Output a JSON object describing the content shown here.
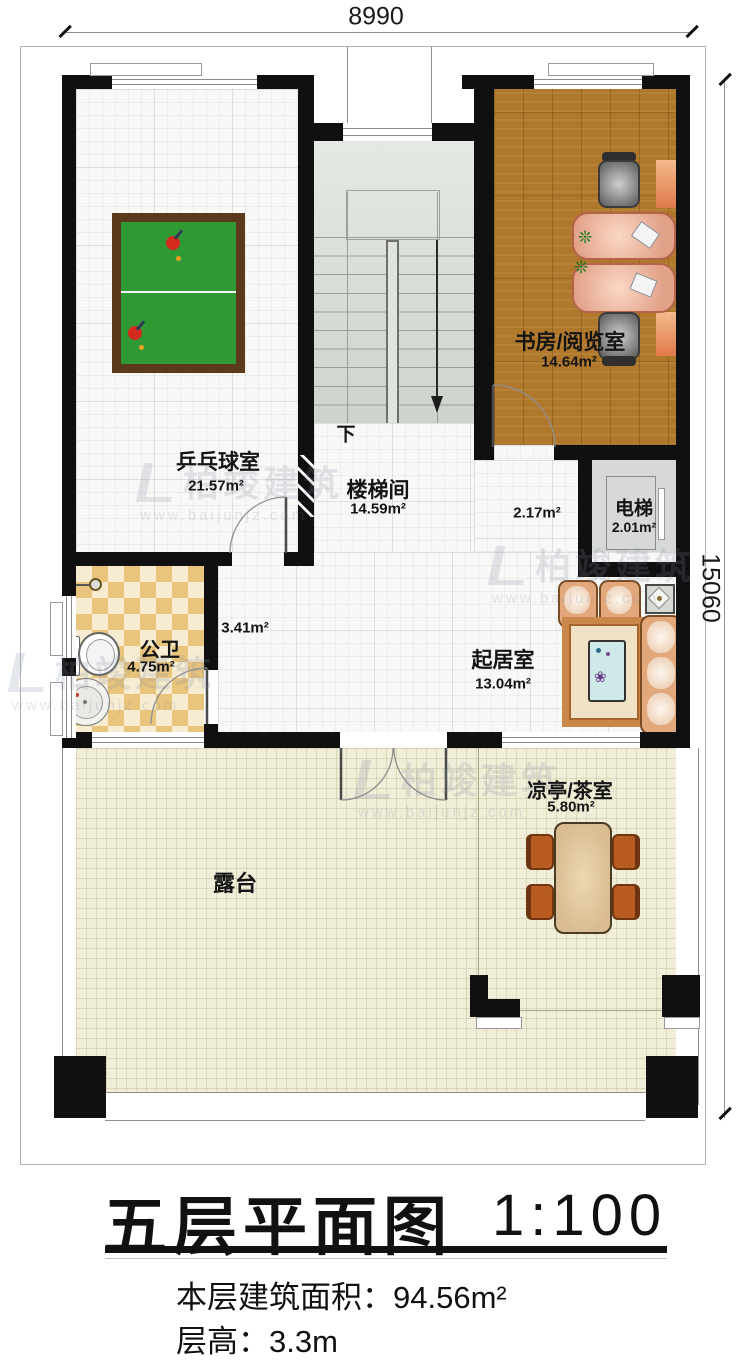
{
  "dimensions": {
    "width_mm": "8990",
    "height_mm": "15060"
  },
  "rooms": {
    "pingpong": {
      "name": "乒乓球室",
      "area": "21.57m²"
    },
    "study": {
      "name": "书房/阅览室",
      "area": "14.64m²"
    },
    "stairwell": {
      "name": "楼梯间",
      "area": "14.59m²",
      "direction": "下"
    },
    "elevator": {
      "name": "电梯",
      "area": "2.01m²"
    },
    "bathroom": {
      "name": "公卫",
      "area": "4.75m²"
    },
    "living": {
      "name": "起居室",
      "area": "13.04m²"
    },
    "tearoom": {
      "name": "凉亭/茶室",
      "area": "5.80m²"
    },
    "terrace": {
      "name": "露台"
    },
    "hall_upper_area": "2.17m²",
    "hall_lower_area": "3.41m²"
  },
  "title": {
    "main": "五层平面图",
    "scale": "1:100",
    "area_line": "本层建筑面积：94.56m²",
    "height_line": "层高：3.3m"
  },
  "watermark": {
    "name": "柏竣建筑",
    "url": "www.baijunjz.com"
  },
  "colors": {
    "wall": "#101010",
    "wood_floor": "#b0782a",
    "terrace_floor": "#f0edd8",
    "stair_floor": "#dde3dd",
    "pingpong_table": "#2f9933",
    "bathroom_tile": "#e9c47c",
    "sofa": "#e2a87c",
    "tea_chair": "#b85c22"
  }
}
